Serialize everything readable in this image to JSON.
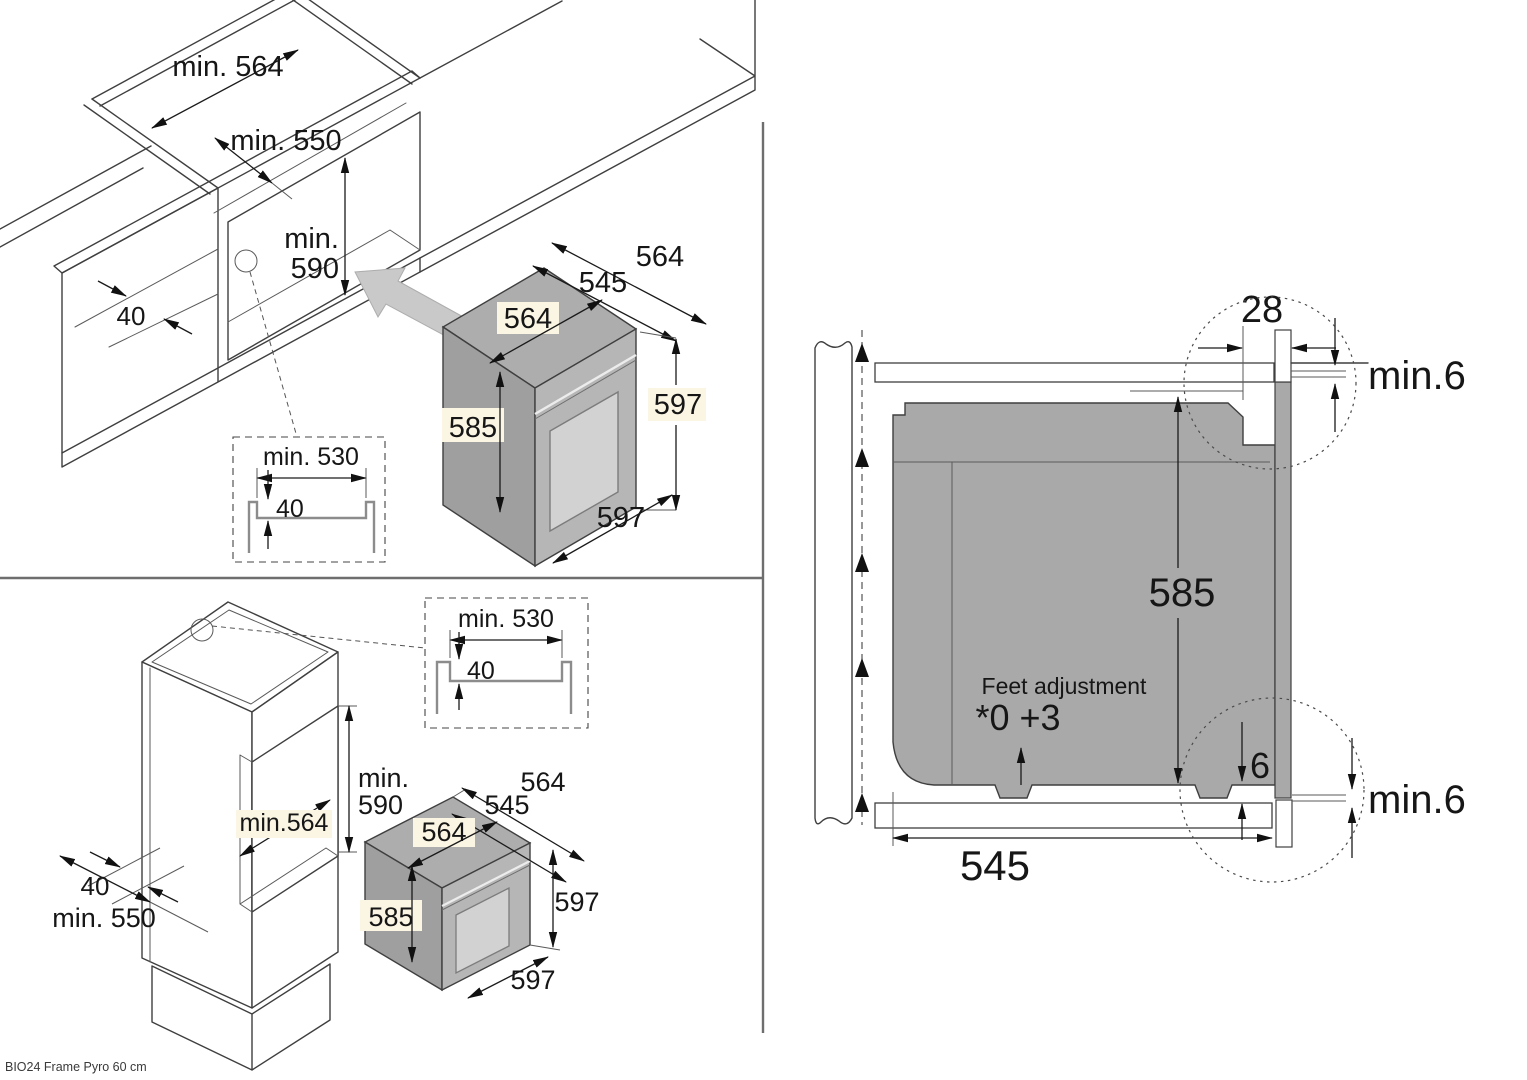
{
  "footer": {
    "model_label": "BIO24 Frame Pyro 60 cm"
  },
  "base_install": {
    "niche_width": "min. 564",
    "niche_depth": "min. 550",
    "niche_height_min": "min.",
    "niche_height_val": "590",
    "rail_width": "40",
    "detail": {
      "recess_width": "min. 530",
      "recess_depth": "40"
    },
    "oven": {
      "depth_total": "564",
      "depth_body": "545",
      "width_top": "564",
      "height_body": "585",
      "height_front": "597",
      "width_front": "597"
    }
  },
  "column_install": {
    "niche_width_inner": "min.564",
    "niche_depth": "min. 550",
    "niche_height_min": "min.",
    "niche_height_val": "590",
    "rail_width": "40",
    "detail": {
      "recess_width": "min. 530",
      "recess_depth": "40"
    },
    "oven": {
      "depth_total": "564",
      "depth_body": "545",
      "width_top": "564",
      "height_body": "585",
      "height_front": "597",
      "width_front": "597"
    }
  },
  "side_view": {
    "front_offset": "28",
    "top_clearance": "min.6",
    "body_height": "585",
    "feet_title": "Feet adjustment",
    "feet_range": "*0 +3",
    "bottom_gap": "6",
    "bottom_clearance": "min.6",
    "body_depth": "545"
  },
  "colors": {
    "oven_gray": "#a9a9a9",
    "accent_cream": "#fbf6e3",
    "line": "#3f3f3f"
  }
}
